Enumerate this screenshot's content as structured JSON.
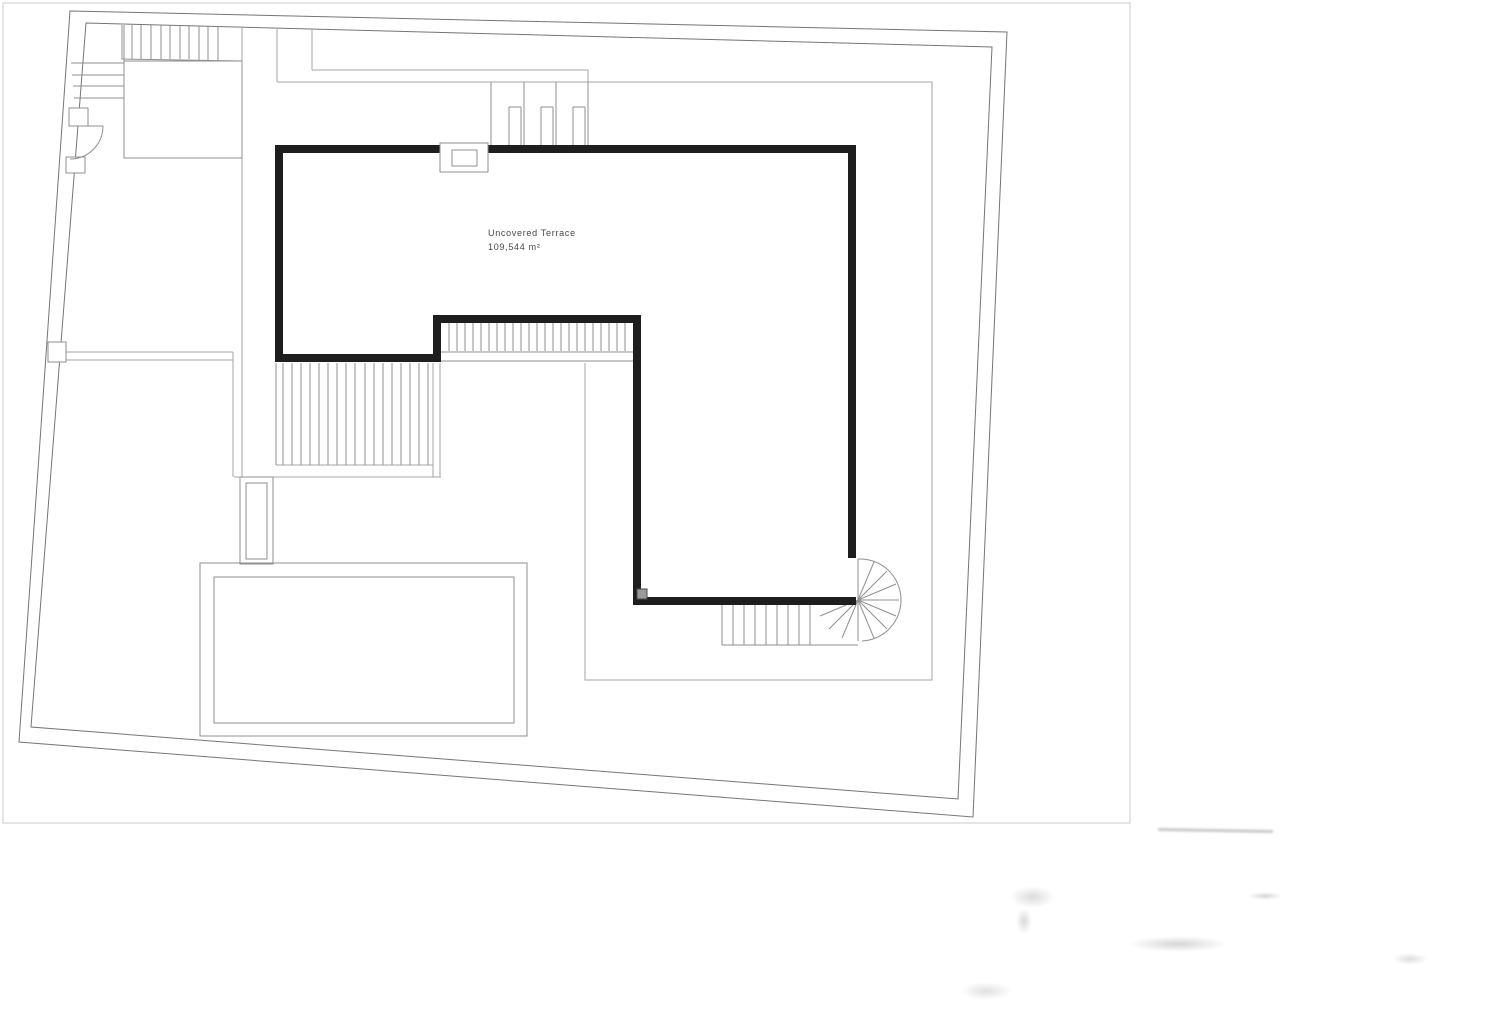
{
  "label": {
    "room": "Uncovered Terrace",
    "area": "109,544 m²"
  },
  "colors": {
    "wall": "#1e1e1e",
    "boundary": "#757575",
    "line": "#8f8f8f",
    "light_line": "#a6a6a6",
    "frame": "#cbcbcb",
    "text": "#474747",
    "paper": "#ffffff"
  }
}
